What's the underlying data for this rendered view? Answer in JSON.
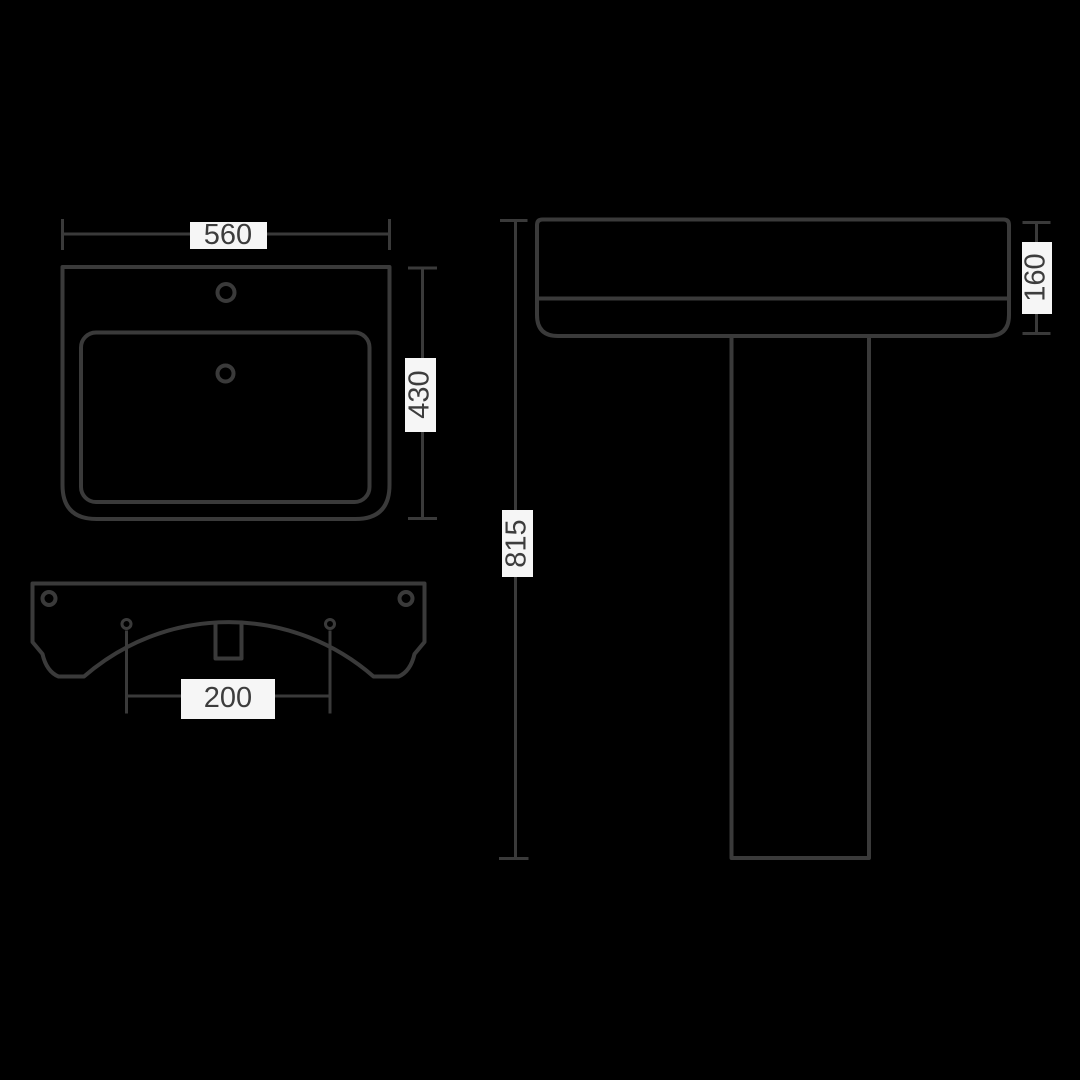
{
  "colors": {
    "background": "#000000",
    "line": "#3a3a3a",
    "label_background": "#f6f6f6",
    "label_text": "#3d3d3d"
  },
  "labels": {
    "plan_width": "560",
    "plan_depth": "430",
    "fixing_centres": "200",
    "overall_height": "815",
    "rim_depth": "160"
  }
}
